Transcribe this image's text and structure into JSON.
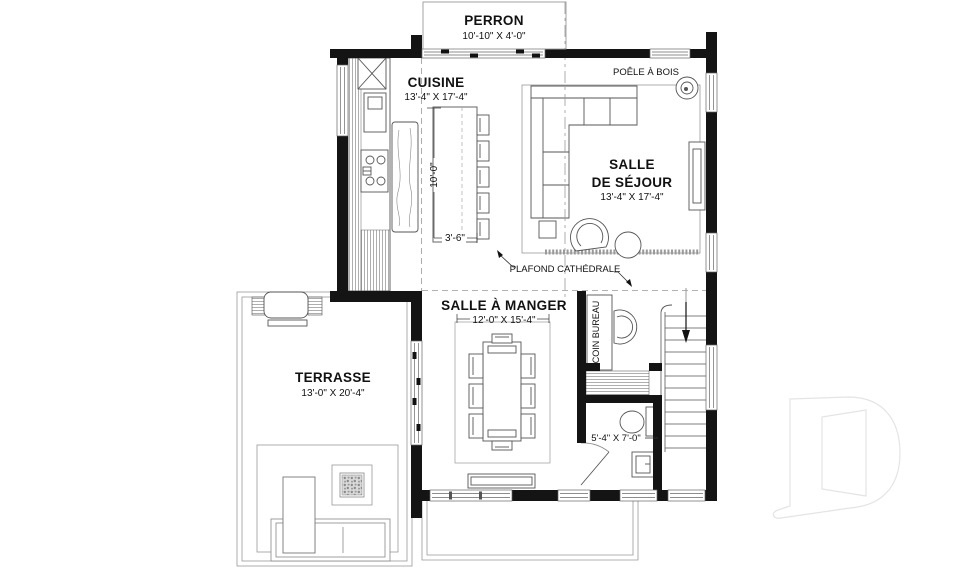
{
  "plan": {
    "perron": {
      "name": "PERRON",
      "dims": "10'-10\" X 4'-0\""
    },
    "cuisine": {
      "name": "CUISINE",
      "dims": "13'-4\" X 17'-4\""
    },
    "salle_de_sejour": {
      "name_line1": "SALLE",
      "name_line2": "DE SÉJOUR",
      "dims": "13'-4\" X 17'-4\""
    },
    "salle_a_manger": {
      "name": "SALLE À MANGER",
      "dims": "12'-0\" X 15'-4\""
    },
    "terrasse": {
      "name": "TERRASSE",
      "dims": "13'-0\" X 20'-4\""
    },
    "salle_eau": {
      "dims": "5'-4\" X 7'-0\""
    },
    "coin_bureau": {
      "name": "COIN BUREAU"
    },
    "annotations": {
      "poele_a_bois": "POÊLE À BOIS",
      "plafond_cathedrale": "PLAFOND CATHÉDRALE"
    },
    "dimensions": {
      "island_length": "10'-0\"",
      "island_clearance": "3'-6\""
    }
  },
  "colors": {
    "wall": "#141414",
    "line": "#555555",
    "light_line": "#999999",
    "watermark": "#e4e4e4",
    "background": "#ffffff"
  }
}
